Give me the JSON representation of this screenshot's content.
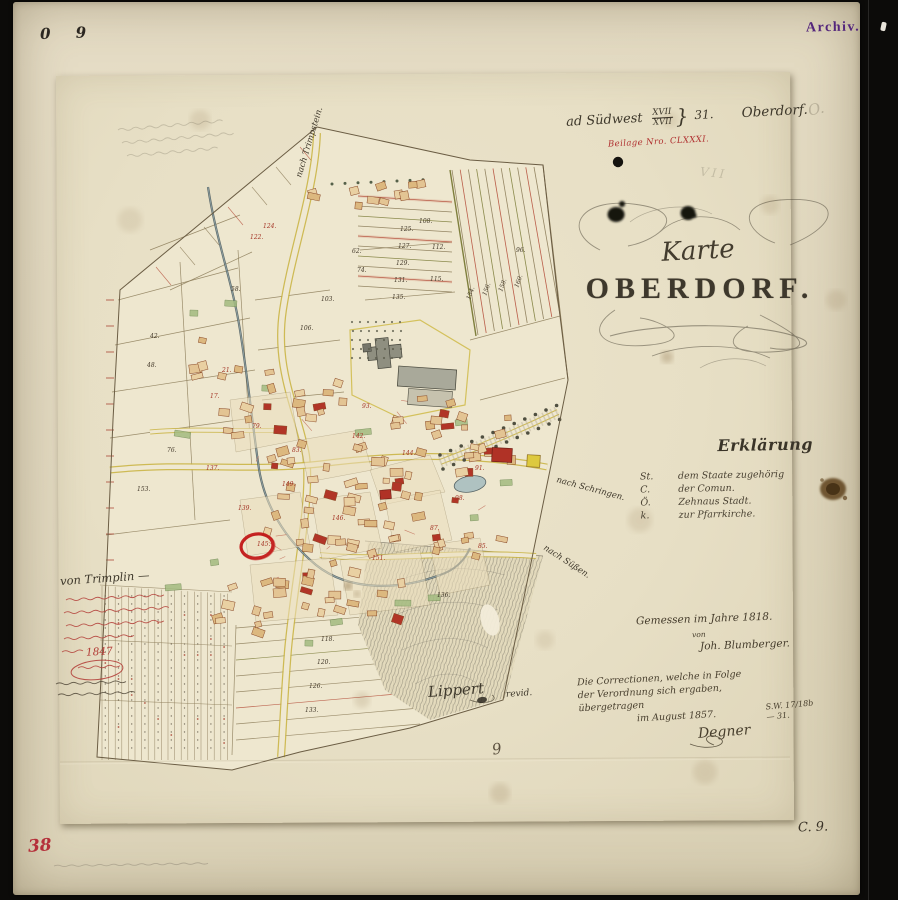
{
  "marks": {
    "top_left": "0 9",
    "archiv": "Archiv.",
    "pencil_vii": "VII",
    "pencil_o": "O.",
    "sheet_digit": "9",
    "bottom_right": "C. 9.",
    "red_number": "38"
  },
  "header": {
    "prefix": "ad Südwest",
    "fraction_top": "XVII",
    "fraction_bottom": "XVII",
    "brace": "}",
    "number": "31.",
    "place": "Oberdorf.",
    "red_line": "Beilage Nro. CLXXXI."
  },
  "title": {
    "upper": "Karte",
    "main": "OBERDORF."
  },
  "legend": {
    "heading": "Erklärung",
    "items": [
      {
        "key": "St.",
        "label": "dem Staate zugehörig"
      },
      {
        "key": "C.",
        "label": "der Comun."
      },
      {
        "key": "Ö.",
        "label": "Zehnaus Stadt."
      },
      {
        "key": "k.",
        "label": "zur Pfarrkirche."
      }
    ]
  },
  "survey": {
    "line1": "Gemessen im Jahre 1818.",
    "line2": "von",
    "line3": "Joh. Blumberger."
  },
  "correction": {
    "lines": [
      "Die Correctionen, welche in Folge",
      "der Verordnung sich ergaben,",
      "übergetragen",
      "im August 1857."
    ],
    "signature": "Degner",
    "ref": "S.W. 17/18b — 31."
  },
  "revision": {
    "name": "Lippert",
    "note": "revid."
  },
  "margin": {
    "heading": "von Trimplin —",
    "year": "1847"
  },
  "map": {
    "road_labels": [
      {
        "text": "nach Trimpstein.",
        "x": 301,
        "y": 178,
        "rot": -73
      },
      {
        "text": "nach Schringen.",
        "x": 556,
        "y": 482,
        "rot": 15
      },
      {
        "text": "nach Süßen.",
        "x": 543,
        "y": 549,
        "rot": 33
      }
    ],
    "parcel_numbers": [
      {
        "t": "42.",
        "x": 150,
        "y": 338,
        "c": "k"
      },
      {
        "t": "48.",
        "x": 147,
        "y": 367,
        "c": "k"
      },
      {
        "t": "58.",
        "x": 231,
        "y": 291,
        "c": "k"
      },
      {
        "t": "62.",
        "x": 352,
        "y": 253,
        "c": "k"
      },
      {
        "t": "74.",
        "x": 357,
        "y": 272,
        "c": "k"
      },
      {
        "t": "76.",
        "x": 167,
        "y": 452,
        "c": "k"
      },
      {
        "t": "96.",
        "x": 516,
        "y": 252,
        "c": "k"
      },
      {
        "t": "103.",
        "x": 321,
        "y": 301,
        "c": "k"
      },
      {
        "t": "106.",
        "x": 300,
        "y": 330,
        "c": "k"
      },
      {
        "t": "108.",
        "x": 419,
        "y": 223,
        "c": "k"
      },
      {
        "t": "112.",
        "x": 432,
        "y": 249,
        "c": "k"
      },
      {
        "t": "115.",
        "x": 430,
        "y": 281,
        "c": "k"
      },
      {
        "t": "118.",
        "x": 321,
        "y": 641,
        "c": "k"
      },
      {
        "t": "120.",
        "x": 317,
        "y": 664,
        "c": "k"
      },
      {
        "t": "126.",
        "x": 309,
        "y": 688,
        "c": "k"
      },
      {
        "t": "133.",
        "x": 305,
        "y": 712,
        "c": "k"
      },
      {
        "t": "136.",
        "x": 437,
        "y": 597,
        "c": "k"
      },
      {
        "t": "153.",
        "x": 137,
        "y": 491,
        "c": "k"
      },
      {
        "t": "125.",
        "x": 400,
        "y": 231,
        "c": "k"
      },
      {
        "t": "127.",
        "x": 398,
        "y": 248,
        "c": "k"
      },
      {
        "t": "129.",
        "x": 396,
        "y": 265,
        "c": "k"
      },
      {
        "t": "131.",
        "x": 394,
        "y": 282,
        "c": "k"
      },
      {
        "t": "135.",
        "x": 392,
        "y": 299,
        "c": "k"
      },
      {
        "t": "154.",
        "x": 470,
        "y": 300,
        "c": "k",
        "r": -70
      },
      {
        "t": "156.",
        "x": 486,
        "y": 296,
        "c": "k",
        "r": -70
      },
      {
        "t": "158.",
        "x": 502,
        "y": 292,
        "c": "k",
        "r": -70
      },
      {
        "t": "160.",
        "x": 518,
        "y": 288,
        "c": "k",
        "r": -70
      },
      {
        "t": "122.",
        "x": 250,
        "y": 239,
        "c": "r"
      },
      {
        "t": "124.",
        "x": 263,
        "y": 228,
        "c": "r"
      },
      {
        "t": "137.",
        "x": 206,
        "y": 470,
        "c": "r"
      },
      {
        "t": "139.",
        "x": 238,
        "y": 510,
        "c": "r"
      },
      {
        "t": "142.",
        "x": 352,
        "y": 438,
        "c": "r"
      },
      {
        "t": "144.",
        "x": 402,
        "y": 455,
        "c": "r"
      },
      {
        "t": "146.",
        "x": 332,
        "y": 520,
        "c": "r"
      },
      {
        "t": "149.",
        "x": 282,
        "y": 486,
        "c": "r"
      },
      {
        "t": "151.",
        "x": 372,
        "y": 560,
        "c": "r"
      },
      {
        "t": "98.",
        "x": 455,
        "y": 500,
        "c": "r"
      },
      {
        "t": "91.",
        "x": 475,
        "y": 470,
        "c": "r"
      },
      {
        "t": "87.",
        "x": 430,
        "y": 530,
        "c": "r"
      },
      {
        "t": "145.",
        "x": 257,
        "y": 546,
        "c": "r"
      },
      {
        "t": "93.",
        "x": 362,
        "y": 408,
        "c": "r"
      },
      {
        "t": "85.",
        "x": 478,
        "y": 548,
        "c": "r"
      },
      {
        "t": "79.",
        "x": 252,
        "y": 428,
        "c": "r"
      },
      {
        "t": "83.",
        "x": 292,
        "y": 452,
        "c": "r"
      },
      {
        "t": "21.",
        "x": 222,
        "y": 372,
        "c": "r"
      },
      {
        "t": "17.",
        "x": 210,
        "y": 398,
        "c": "r"
      }
    ]
  }
}
